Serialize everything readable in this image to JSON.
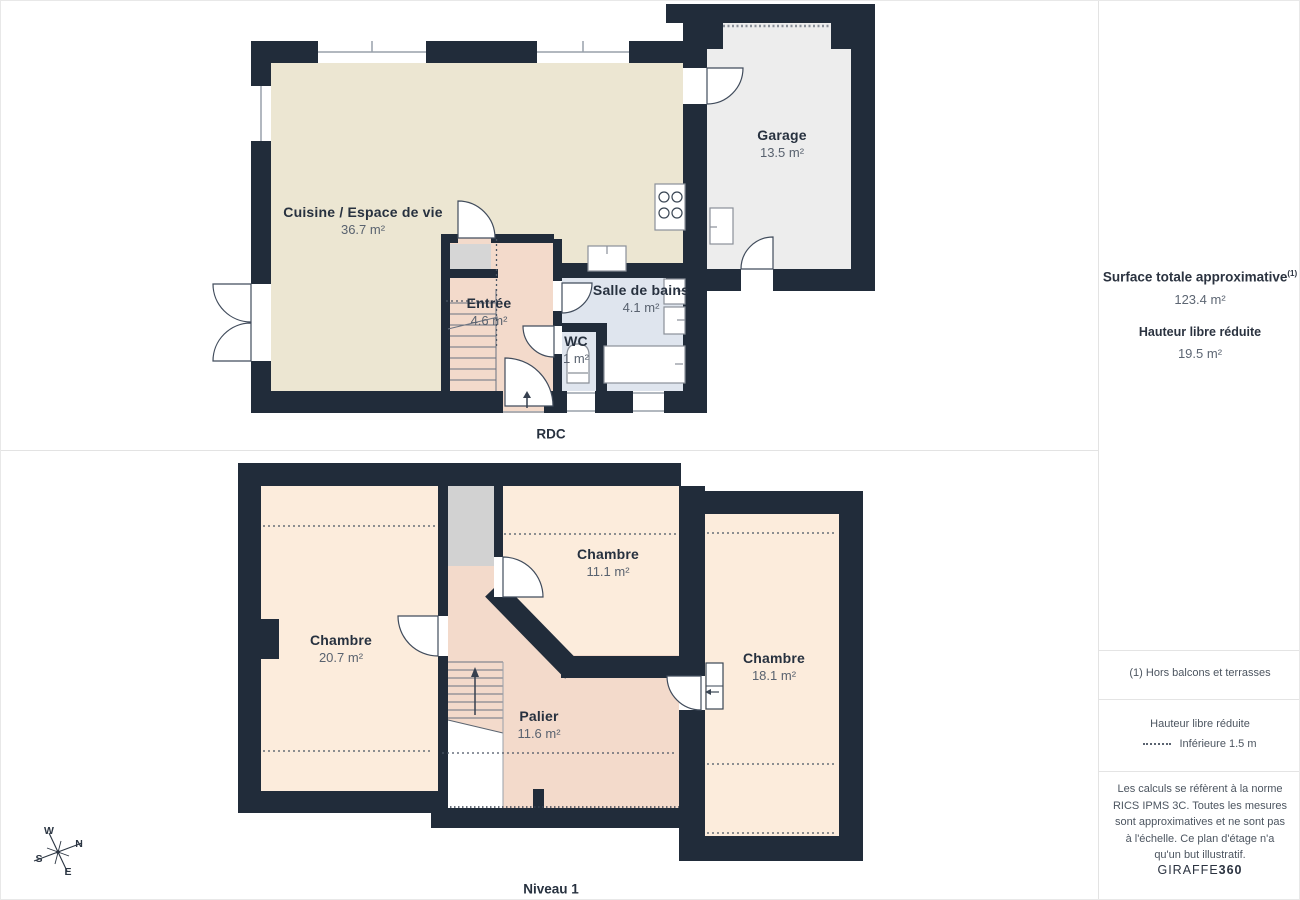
{
  "floors": [
    {
      "label": "RDC",
      "rooms": [
        {
          "name": "Cuisine / Espace de vie",
          "area": "36.7 m²"
        },
        {
          "name": "Garage",
          "area": "13.5 m²"
        },
        {
          "name": "Entrée",
          "area": "4.6 m²"
        },
        {
          "name": "Salle de bains",
          "area": "4.1 m²"
        },
        {
          "name": "WC",
          "area": "1 m²"
        }
      ]
    },
    {
      "label": "Niveau 1",
      "rooms": [
        {
          "name": "Chambre",
          "area": "20.7 m²"
        },
        {
          "name": "Chambre",
          "area": "11.1 m²"
        },
        {
          "name": "Chambre",
          "area": "18.1 m²"
        },
        {
          "name": "Palier",
          "area": "11.6 m²"
        }
      ]
    }
  ],
  "sidebar": {
    "surface_title": "Surface totale approximative",
    "surface_footnote_marker": "(1)",
    "surface_value": "123.4 m²",
    "reduced_height_title": "Hauteur libre réduite",
    "reduced_height_value": "19.5 m²",
    "footnote": "(1) Hors balcons et terrasses",
    "legend_title": "Hauteur libre réduite",
    "legend_item": "Inférieure 1.5 m",
    "disclaimer": "Les calculs se réfèrent à la norme RICS IPMS 3C. Toutes les mesures sont approximatives et ne sont pas à l'échelle. Ce plan d'étage n'a qu'un but illustratif.",
    "brand_name": "GIRAFFE",
    "brand_suffix": "360"
  },
  "compass": {
    "w": "W",
    "n": "N",
    "s": "S",
    "e": "E"
  },
  "colors": {
    "wall": "#212c3a",
    "kitchen_floor": "#ece6d2",
    "hall_floor": "#f3dacb",
    "bath_floor": "#dfe5ee",
    "garage_floor": "#ededed",
    "bedroom_floor": "#fcecdc",
    "stairwell_gray": "#d2d2d2",
    "divider_gray": "#e3e3e3"
  }
}
